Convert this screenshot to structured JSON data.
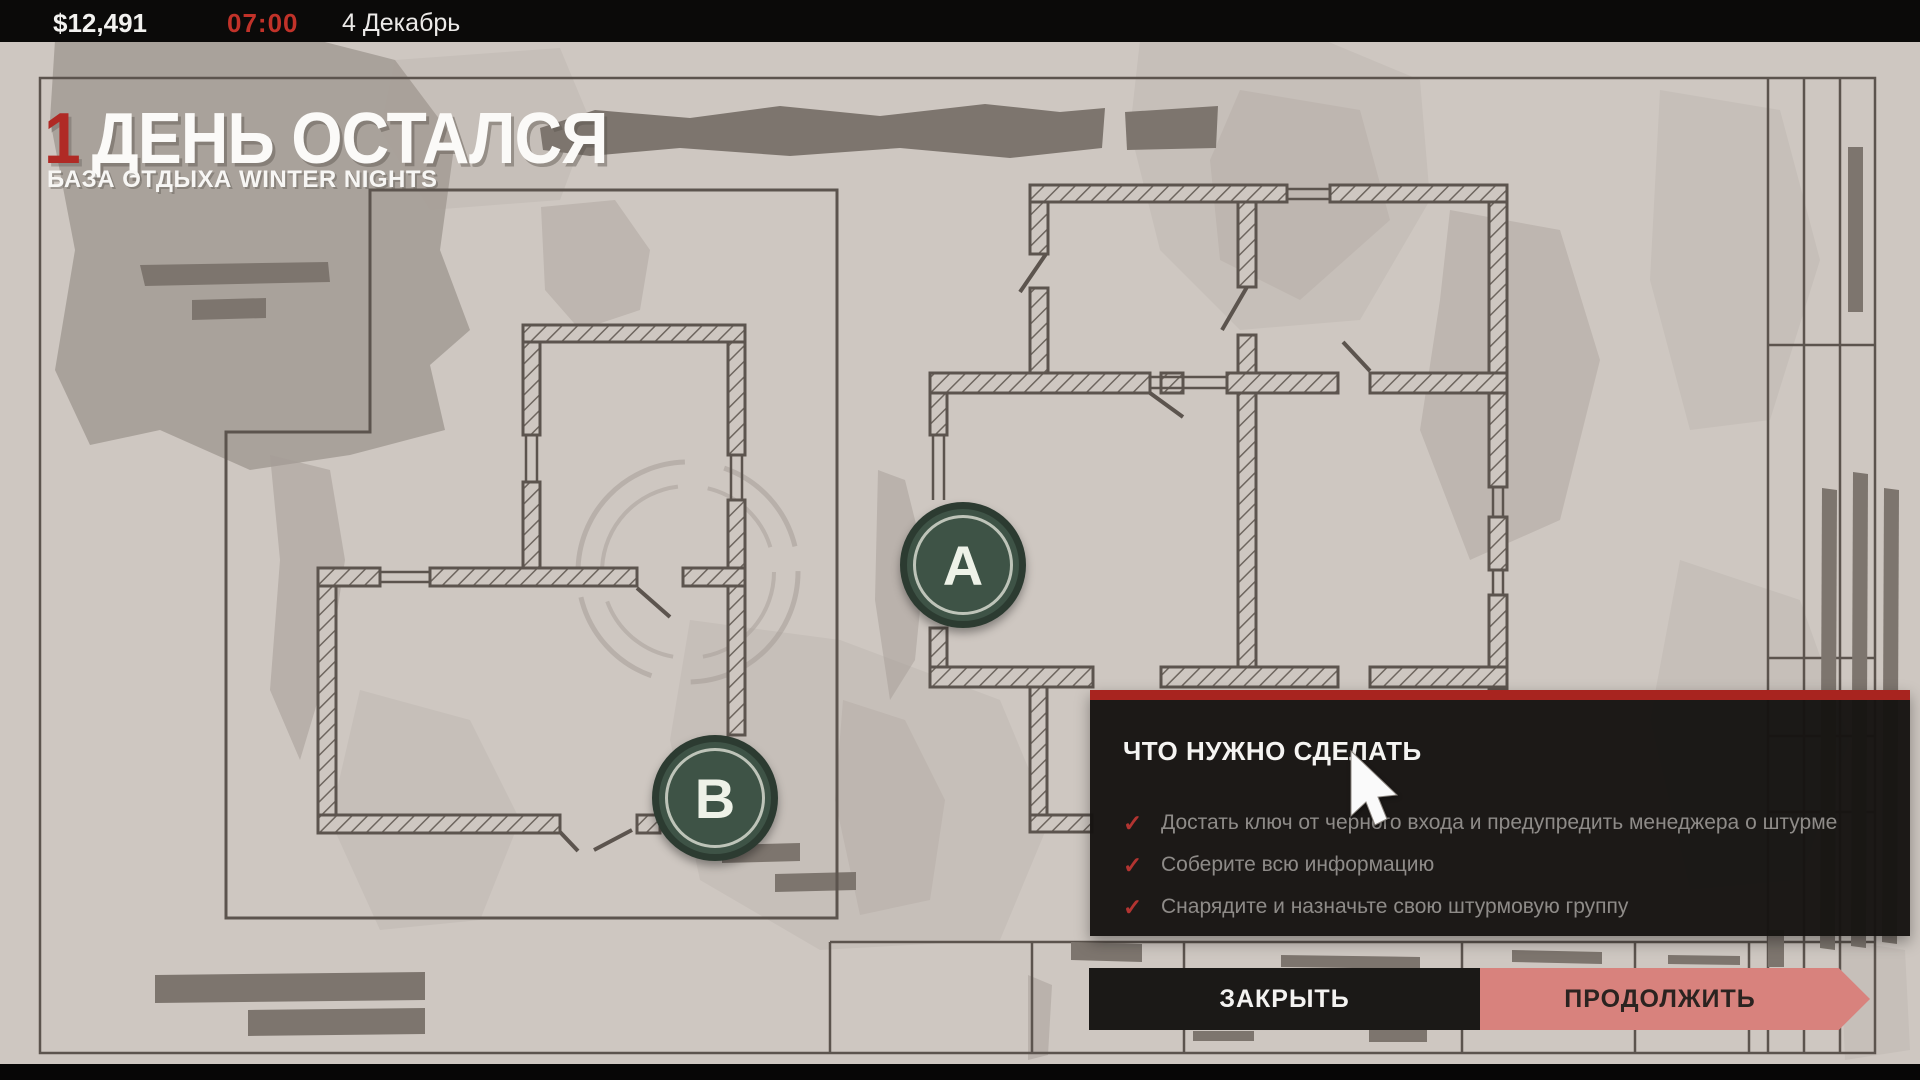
{
  "topbar": {
    "money": "$12,491",
    "time": "07:00",
    "date": "4 Декабрь"
  },
  "header": {
    "days_number": "1",
    "title": "ДЕНЬ ОСТАЛСЯ",
    "subtitle": "БАЗА ОТДЫХА WINTER NIGHTS"
  },
  "map": {
    "markers": [
      {
        "label": "A"
      },
      {
        "label": "B"
      }
    ]
  },
  "panel": {
    "title": "ЧТО НУЖНО СДЕЛАТЬ",
    "check_glyph": "✓",
    "tasks": [
      "Достать ключ от черного входа и предупредить менеджера о штурме",
      "Соберите всю информацию",
      "Снарядите и назначьте свою штурмовую группу"
    ]
  },
  "actions": {
    "close": "ЗАКРЫТЬ",
    "continue": "ПРОДОЛЖИТЬ"
  },
  "colors": {
    "paper": "#cec7c1",
    "ink": "#5c544e",
    "hatch": "#6e665f",
    "strip": "#7d756e",
    "topbar_bg": "#0b0a09",
    "accent_red": "#b02a25",
    "time_red": "#c13229",
    "panel_bg": "#161412",
    "panel_red": "#a8241f",
    "task_text": "#8e8b88",
    "check_red": "#b23431",
    "btn_dark": "#1b1917",
    "btn_pink": "#d8827d",
    "marker_fill": "#3e5346",
    "marker_ring": "#ccd0c5"
  }
}
